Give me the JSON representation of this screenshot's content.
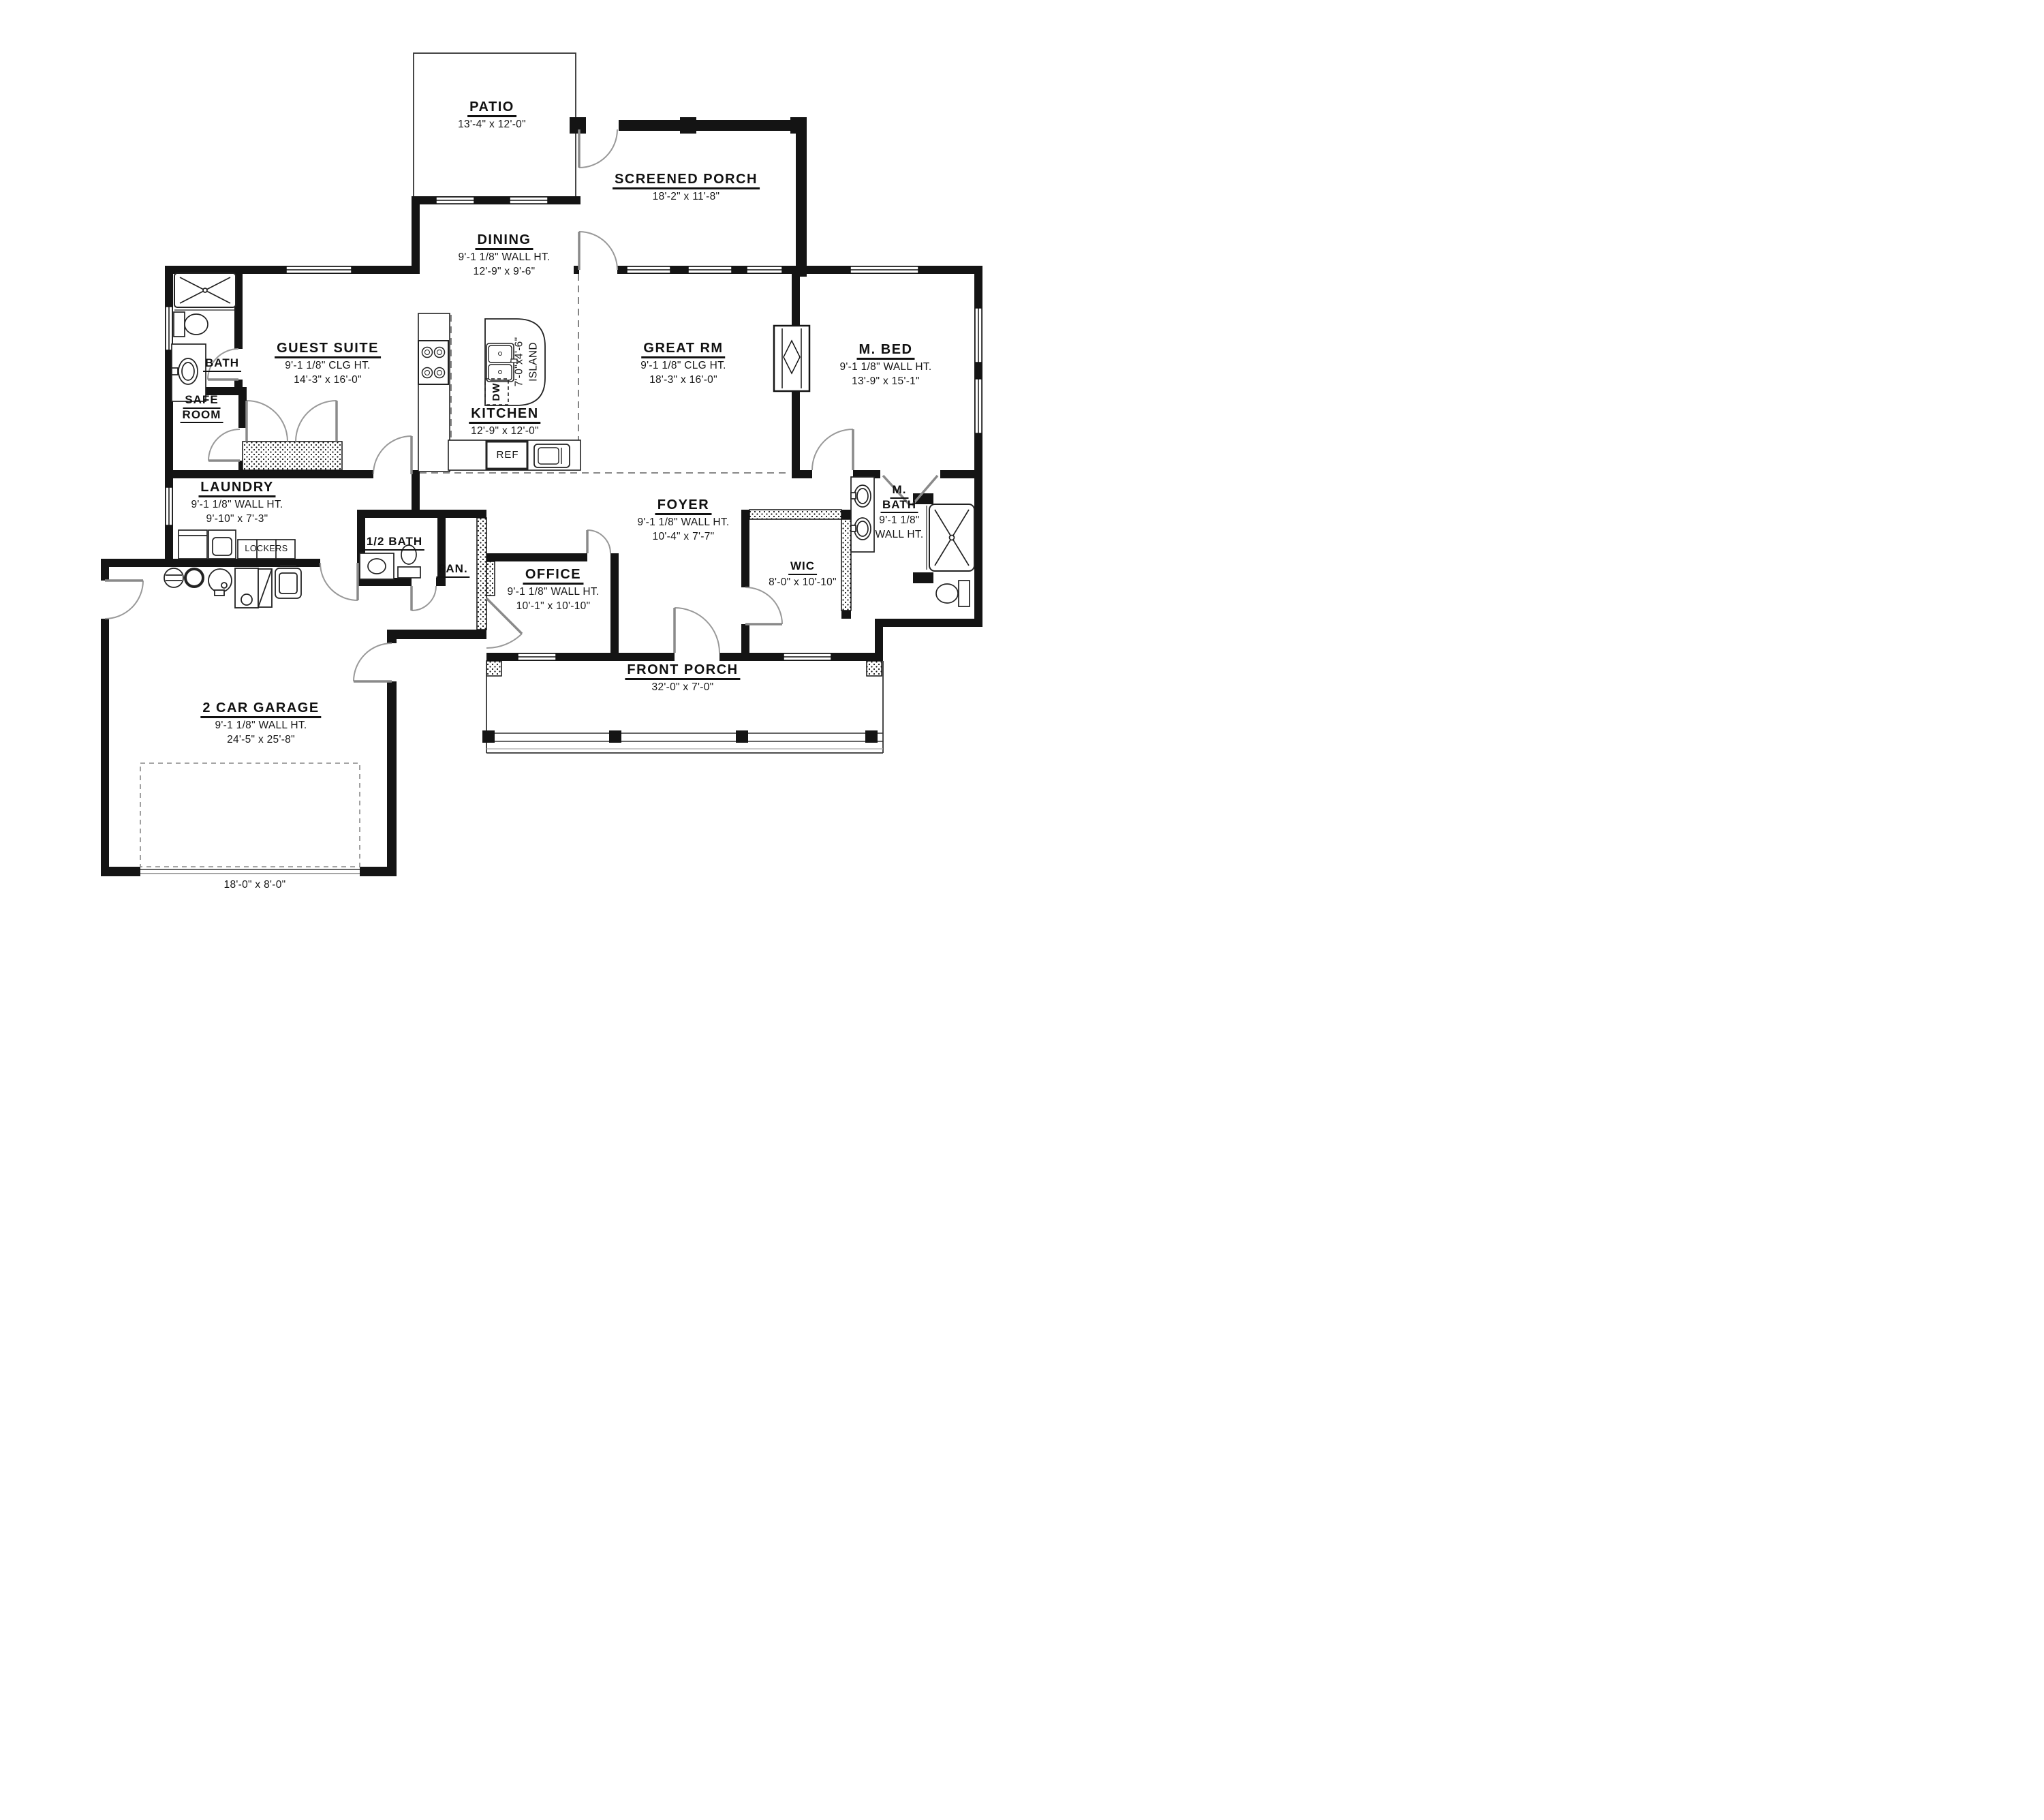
{
  "rooms": {
    "patio": {
      "name": "PATIO",
      "dims": "13'-4\" x 12'-0\""
    },
    "screened_porch": {
      "name": "SCREENED PORCH",
      "dims": "18'-2\" x 11'-8\""
    },
    "dining": {
      "name": "DINING",
      "note": "9'-1 1/8\" WALL HT.",
      "dims": "12'-9\" x 9'-6\""
    },
    "guest_suite": {
      "name": "GUEST SUITE",
      "note": "9'-1 1/8\" CLG HT.",
      "dims": "14'-3\" x 16'-0\""
    },
    "bath": {
      "name": "BATH"
    },
    "safe_room": {
      "line1": "SAFE",
      "line2": "ROOM"
    },
    "great_rm": {
      "name": "GREAT RM",
      "note": "9'-1 1/8\" CLG HT.",
      "dims": "18'-3\" x 16'-0\""
    },
    "m_bed": {
      "name": "M. BED",
      "note": "9'-1 1/8\" WALL HT.",
      "dims": "13'-9\" x 15'-1\""
    },
    "kitchen": {
      "name": "KITCHEN",
      "dims": "12'-9\" x 12'-0\""
    },
    "laundry": {
      "name": "LAUNDRY",
      "note": "9'-1 1/8\" WALL HT.",
      "dims": "9'-10\" x 7'-3\""
    },
    "half_bath": {
      "name": "1/2 BATH"
    },
    "pantry": {
      "name": "PAN."
    },
    "office": {
      "name": "OFFICE",
      "note": "9'-1 1/8\" WALL HT.",
      "dims": "10'-1\" x 10'-10\""
    },
    "foyer": {
      "name": "FOYER",
      "note": "9'-1 1/8\" WALL HT.",
      "dims": "10'-4\" x 7'-7\""
    },
    "m_bath": {
      "line1": "M.",
      "line2": "BATH",
      "note1": "9'-1 1/8\"",
      "note2": "WALL HT."
    },
    "wic": {
      "name": "WIC",
      "dims": "8'-0\" x 10'-10\""
    },
    "front_porch": {
      "name": "FRONT PORCH",
      "dims": "32'-0\" x 7'-0\""
    },
    "garage": {
      "name": "2 CAR GARAGE",
      "note": "9'-1 1/8\" WALL HT.",
      "dims": "24'-5\" x 25'-8\"",
      "door_dims": "18'-0\" x 8'-0\""
    }
  },
  "annotations": {
    "island_line1": "7'-0\"x4'-6\"",
    "island_line2": "ISLAND",
    "dw": "DW",
    "ref": "REF",
    "lockers": "LOCKERS"
  },
  "colors": {
    "wall": "#141414",
    "thin_line": "#333333",
    "door_arc": "#999999",
    "dashed": "#777777",
    "paper": "#ffffff"
  }
}
